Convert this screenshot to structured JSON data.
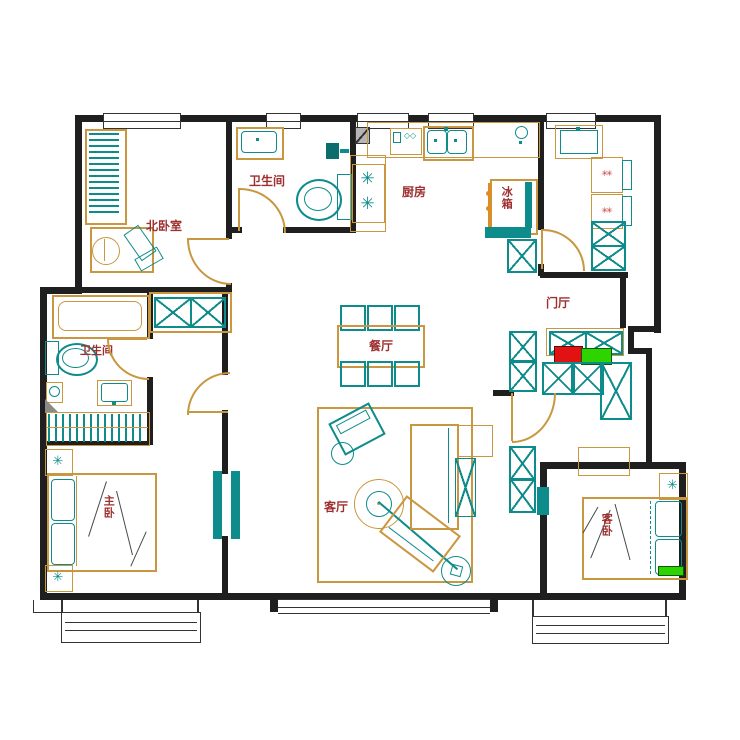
{
  "labels": {
    "north_bedroom": "北卧室",
    "bath_north": "卫生间",
    "kitchen": "厨房",
    "fridge": "冰箱",
    "entry": "门厅",
    "bath_west": "卫生间",
    "dining": "餐厅",
    "living": "客厅",
    "master_bedroom": "主卧",
    "guest_bedroom": "客卧"
  },
  "icons": {
    "plant": "✳",
    "burner": "✳",
    "washer_marks": "✳✳",
    "dish_rack": "◇◇"
  },
  "colors": {
    "wall": "#1f1f1f",
    "furniture_outline": "#c9973f",
    "fixture_outline": "#0e8b8b",
    "label_text": "#9e2f2f",
    "shoe_cabinet_red": "#e31212",
    "shoe_cabinet_green": "#2ed400",
    "background": "#ffffff"
  }
}
